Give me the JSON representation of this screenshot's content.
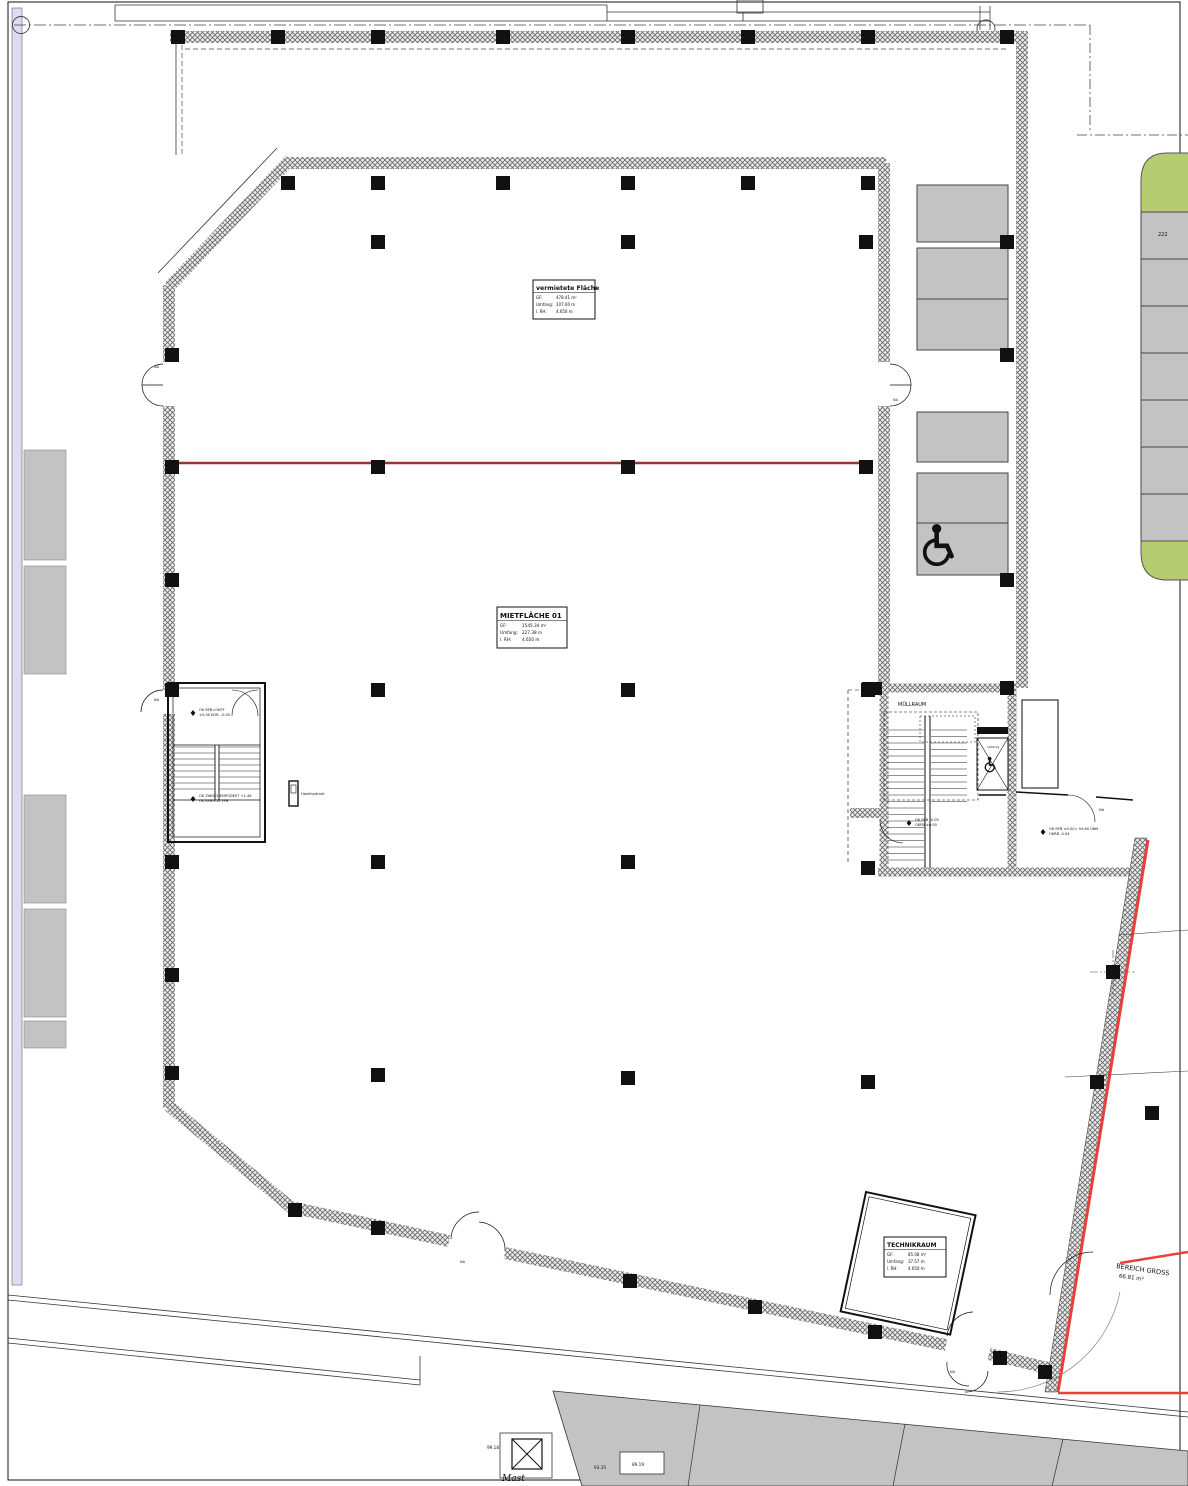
{
  "areas": {
    "vermietete_flaeche": {
      "title": "vermietete Fläche",
      "gf_label": "GF:",
      "gf": "478.41 m²",
      "umfang_label": "Umfang:",
      "umfang": "107.00 m",
      "rh_label": "l. RH:",
      "rh": "4.650 m"
    },
    "mietflaeche_01": {
      "title": "MIETFLÄCHE 01",
      "gf_label": "GF:",
      "gf": "1545.34 m²",
      "umfang_label": "Umfang:",
      "umfang": "227.38 m",
      "rh_label": "l. RH:",
      "rh": "4.650 m"
    },
    "technikraum": {
      "title": "TECHNIKRAUM",
      "gf_label": "GF:",
      "gf": "85.08 m²",
      "umfang_label": "Umfang:",
      "umfang": "37.57 m",
      "rh_label": "l. RH:",
      "rh": "4.650 m"
    },
    "bereich_gross": {
      "title": "BEREICH GROSS",
      "area": "66.81 m²"
    }
  },
  "rooms": {
    "muellraum": "MÜLLRAUM",
    "aufzugschacht": "AUFZUGSCHACHT"
  },
  "elevator": {
    "capacity": "1000 kg"
  },
  "levels": {
    "a1": {
      "l1": "OK RFB=OKFF",
      "l2": "±0.00 KOR. -0.05"
    },
    "a2": {
      "l1": "OK ZWISCHENPODEST +1.48",
      "l2": "OK RFB=OK FFB"
    },
    "b1": {
      "l1": "OK RFB -0.05",
      "l2": "OKFB ±0.00"
    },
    "b2": {
      "l1": "OK RFB ±0.00= 94.60 ÜNN",
      "l2": "OKRB -0.04"
    }
  },
  "site": {
    "mast_label": "Mast",
    "dim_99": "99.18",
    "dim_93": "93.35",
    "dim_89": "89.19",
    "parking_stall_number": "222"
  },
  "doors": {
    "na": "NA"
  },
  "equipment": {
    "handhydrant": "Handhydrant"
  },
  "colors": {
    "red_boundary": "#e8413c",
    "red_separator": "#943634",
    "parking_gray": "#c3c3c3",
    "green_landscape": "#b7cc70",
    "blue_strip": "#dcdcf5",
    "line_dark": "#111111"
  }
}
